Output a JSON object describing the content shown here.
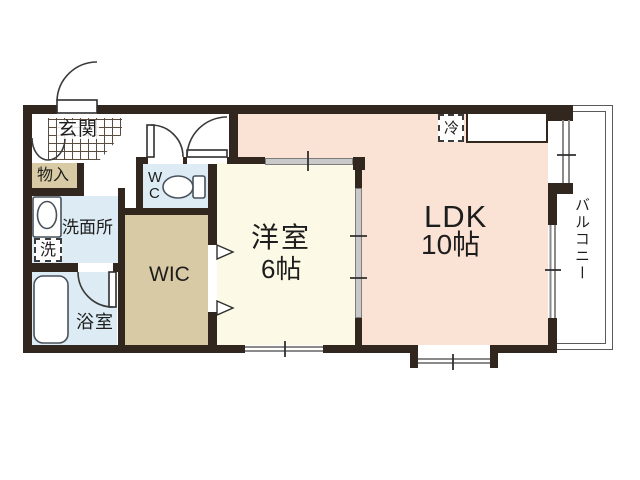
{
  "title": "apartment-floor-plan",
  "rooms": {
    "genkan": {
      "label": "玄関"
    },
    "monoire": {
      "label": "物入"
    },
    "wc": {
      "line1": "W",
      "line2": "C"
    },
    "senmenjo": {
      "label": "洗面所"
    },
    "washer": {
      "label": "洗"
    },
    "yokushitsu": {
      "label": "浴室"
    },
    "wic": {
      "label": "WIC"
    },
    "youshitsu": {
      "label": "洋室",
      "size": "6帖"
    },
    "ldk": {
      "label": "LDK",
      "size": "10帖"
    },
    "balcony": {
      "label": "バルコニー"
    },
    "fridge": {
      "label": "冷"
    }
  },
  "colors": {
    "wall": "#31271e",
    "ldk": "#fae3d4",
    "bedroom": "#fcfae7",
    "storage": "#d8caa4",
    "water": "#dcebf4",
    "slide": "#c9c9c9",
    "slideb": "#7d7d7d",
    "text": "#1d1d1d"
  }
}
